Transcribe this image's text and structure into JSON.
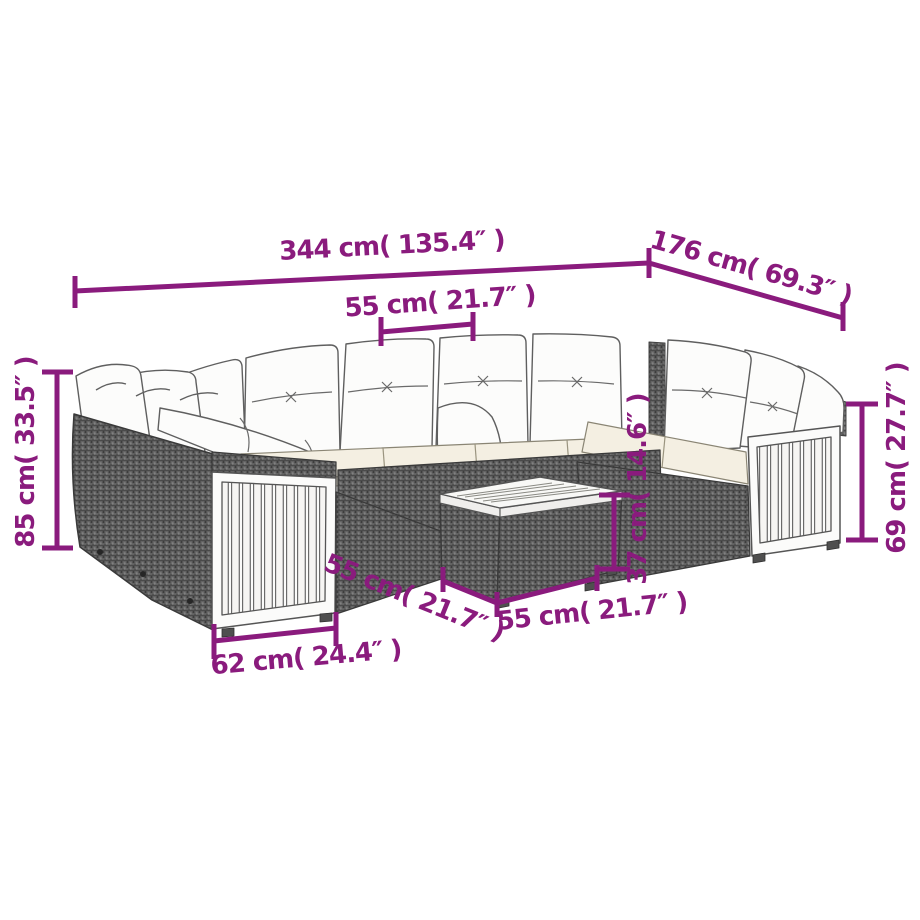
{
  "diagram": {
    "type": "furniture-dimension-diagram",
    "subject": "U-shaped poly rattan garden lounge set with cushions and coffee table",
    "colors": {
      "accent": "#8a1b7d",
      "rattan_gray": "#636363",
      "cushion_white": "#fcfcfb",
      "seat_cushion_ivory": "#f4efe2",
      "wood_panel": "#fbfbfa",
      "outline_gray": "#4a4a4a",
      "background": "#ffffff"
    },
    "dimensions": {
      "overall_width": {
        "cm": 344,
        "inches": 135.4,
        "label": "344 cm( 135.4″ )"
      },
      "overall_depth": {
        "cm": 176,
        "inches": 69.3,
        "label": "176 cm( 69.3″ )"
      },
      "seat_width": {
        "cm": 55,
        "inches": 21.7,
        "label": "55 cm( 21.7″ )"
      },
      "total_height": {
        "cm": 85,
        "inches": 33.5,
        "label": "85 cm( 33.5″ )"
      },
      "arm_height": {
        "cm": 69,
        "inches": 27.7,
        "label": "69 cm( 27.7″ )"
      },
      "table_height": {
        "cm": 37,
        "inches": 14.6,
        "label": "37 cm( 14.6″ )"
      },
      "seat_depth": {
        "cm": 55,
        "inches": 21.7,
        "label": "55 cm( 21.7″ )"
      },
      "table_width": {
        "cm": 55,
        "inches": 21.7,
        "label": "55 cm( 21.7″ )"
      },
      "end_panel_width": {
        "cm": 62,
        "inches": 24.4,
        "label": "62 cm( 24.4″ )"
      }
    }
  }
}
